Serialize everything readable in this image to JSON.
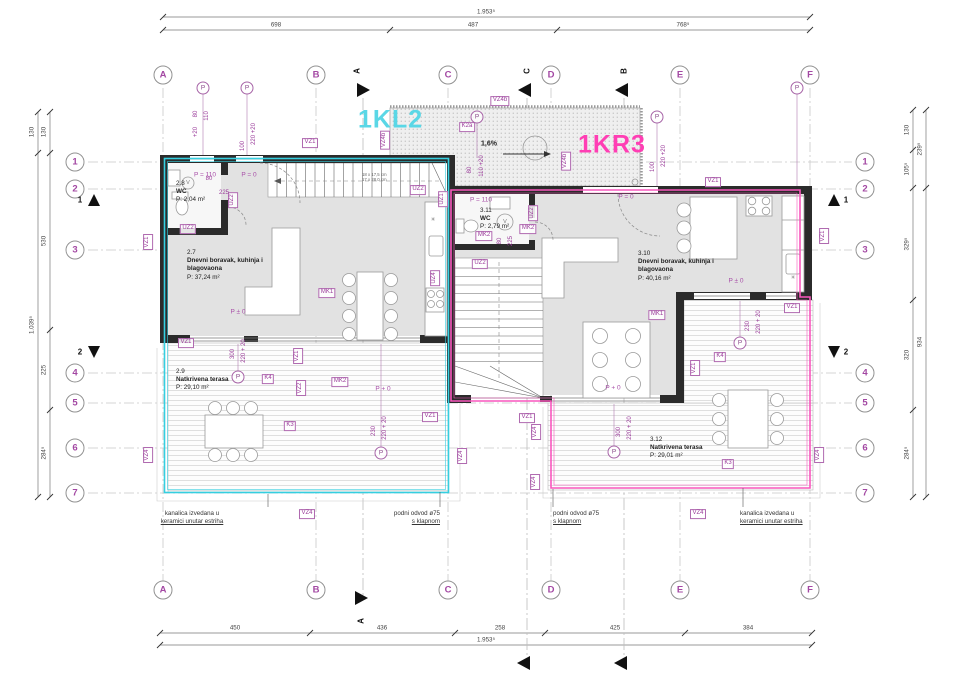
{
  "drawing": {
    "type": "floor-plan",
    "unit_left": {
      "code": "1KL2",
      "color": "#5ad7e6",
      "x": 358,
      "y": 120
    },
    "unit_right": {
      "code": "1KR3",
      "color": "#ff3eb4",
      "x": 578,
      "y": 145
    }
  },
  "grid": {
    "cols": [
      {
        "label": "A",
        "x": 163
      },
      {
        "label": "B",
        "x": 316
      },
      {
        "label": "C",
        "x": 448
      },
      {
        "label": "D",
        "x": 551
      },
      {
        "label": "E",
        "x": 680
      },
      {
        "label": "F",
        "x": 810
      }
    ],
    "rows": [
      {
        "label": "1",
        "y": 162
      },
      {
        "label": "2",
        "y": 189
      },
      {
        "label": "3",
        "y": 250
      },
      {
        "label": "4",
        "y": 373
      },
      {
        "label": "5",
        "y": 403
      },
      {
        "label": "6",
        "y": 448
      },
      {
        "label": "7",
        "y": 493
      }
    ],
    "top_y": 75,
    "bottom_y": 590,
    "left_x": 75,
    "right_x": 865
  },
  "dimensions": [
    {
      "dir": "h",
      "pos": 17,
      "from": 163,
      "to": 810,
      "ticks": [
        163,
        810
      ],
      "labels": [
        {
          "t": "1.953⁵",
          "at": 486
        }
      ]
    },
    {
      "dir": "h",
      "pos": 30,
      "from": 163,
      "to": 810,
      "ticks": [
        163,
        390,
        557,
        810
      ],
      "labels": [
        {
          "t": "698",
          "at": 276
        },
        {
          "t": "487",
          "at": 473
        },
        {
          "t": "768⁵",
          "at": 683
        }
      ]
    },
    {
      "dir": "h",
      "pos": 633,
      "from": 160,
      "to": 812,
      "ticks": [
        160,
        310,
        455,
        545,
        685,
        812
      ],
      "labels": [
        {
          "t": "450",
          "at": 235
        },
        {
          "t": "436",
          "at": 382
        },
        {
          "t": "258",
          "at": 500
        },
        {
          "t": "425",
          "at": 615
        },
        {
          "t": "384",
          "at": 748
        }
      ]
    },
    {
      "dir": "h",
      "pos": 645,
      "from": 160,
      "to": 812,
      "ticks": [
        160,
        812
      ],
      "labels": [
        {
          "t": "1.953⁵",
          "at": 486
        }
      ]
    },
    {
      "dir": "v",
      "pos": 38,
      "from": 112,
      "to": 497,
      "ticks": [
        112,
        153,
        497
      ],
      "labels": [
        {
          "t": "130",
          "at": 132
        },
        {
          "t": "1.039⁵",
          "at": 325
        }
      ]
    },
    {
      "dir": "v",
      "pos": 50,
      "from": 112,
      "to": 497,
      "ticks": [
        112,
        153,
        330,
        410,
        497
      ],
      "labels": [
        {
          "t": "130",
          "at": 132
        },
        {
          "t": "530",
          "at": 241
        },
        {
          "t": "225",
          "at": 370
        },
        {
          "t": "284⁵",
          "at": 453
        }
      ]
    },
    {
      "dir": "v",
      "pos": 913,
      "from": 110,
      "to": 497,
      "ticks": [
        110,
        150,
        188,
        300,
        410,
        497
      ],
      "labels": [
        {
          "t": "130",
          "at": 130
        },
        {
          "t": "105⁵",
          "at": 169
        },
        {
          "t": "329⁵",
          "at": 244
        },
        {
          "t": "320",
          "at": 355
        },
        {
          "t": "284⁵",
          "at": 453
        }
      ]
    },
    {
      "dir": "v",
      "pos": 926,
      "from": 110,
      "to": 497,
      "ticks": [
        110,
        188,
        497
      ],
      "labels": [
        {
          "t": "239⁵",
          "at": 149
        },
        {
          "t": "934",
          "at": 342
        }
      ]
    }
  ],
  "rooms": [
    {
      "id": "2.8",
      "name_lines": [
        "WC"
      ],
      "area": "P: 2,04 m²",
      "x": 176,
      "y": 180
    },
    {
      "id": "2.7",
      "name_lines": [
        "Dnevni boravak, kuhinja i",
        "blagovaona"
      ],
      "area": "P: 37,24 m²",
      "x": 187,
      "y": 249
    },
    {
      "id": "2.9",
      "name_lines": [
        "Natkrivena terasa"
      ],
      "area": "P: 29,10 m²",
      "x": 176,
      "y": 368
    },
    {
      "id": "3.11",
      "name_lines": [
        "WC"
      ],
      "area": "P: 2,79 m²",
      "x": 480,
      "y": 207
    },
    {
      "id": "3.10",
      "name_lines": [
        "Dnevni boravak, kuhinja i",
        "blagovaona"
      ],
      "area": "P: 40,16 m²",
      "x": 638,
      "y": 250
    },
    {
      "id": "3.12",
      "name_lines": [
        "Natkrivena terasa"
      ],
      "area": "P: 29,01 m²",
      "x": 650,
      "y": 436
    }
  ],
  "tags": [
    {
      "t": "VZ1",
      "x": 310,
      "y": 143
    },
    {
      "t": "VZ4b",
      "x": 500,
      "y": 101
    },
    {
      "t": "VZ4b",
      "x": 385,
      "y": 140,
      "v": true
    },
    {
      "t": "VZ4b",
      "x": 566,
      "y": 161,
      "v": true
    },
    {
      "t": "K2a",
      "x": 467,
      "y": 127
    },
    {
      "t": "UZ2",
      "x": 188,
      "y": 229
    },
    {
      "t": "UZ2",
      "x": 233,
      "y": 200,
      "v": true
    },
    {
      "t": "UZ2",
      "x": 418,
      "y": 190
    },
    {
      "t": "UZ1",
      "x": 443,
      "y": 199,
      "v": true
    },
    {
      "t": "VZ1",
      "x": 148,
      "y": 242,
      "v": true
    },
    {
      "t": "MK1",
      "x": 327,
      "y": 293
    },
    {
      "t": "UZ4",
      "x": 435,
      "y": 278,
      "v": true
    },
    {
      "t": "MK2",
      "x": 340,
      "y": 382
    },
    {
      "t": "VZ1",
      "x": 186,
      "y": 343
    },
    {
      "t": "VZ1",
      "x": 298,
      "y": 356,
      "v": true
    },
    {
      "t": "VZ2",
      "x": 301,
      "y": 388,
      "v": true
    },
    {
      "t": "K4",
      "x": 268,
      "y": 379
    },
    {
      "t": "K3",
      "x": 290,
      "y": 426
    },
    {
      "t": "VZ1",
      "x": 430,
      "y": 417
    },
    {
      "t": "VZ4",
      "x": 148,
      "y": 455,
      "v": true
    },
    {
      "t": "VZ4",
      "x": 462,
      "y": 456,
      "v": true
    },
    {
      "t": "VZ4",
      "x": 307,
      "y": 514
    },
    {
      "t": "VZ1",
      "x": 713,
      "y": 182
    },
    {
      "t": "UZ2",
      "x": 533,
      "y": 213,
      "v": true
    },
    {
      "t": "MK2",
      "x": 484,
      "y": 236
    },
    {
      "t": "MK2",
      "x": 528,
      "y": 229
    },
    {
      "t": "UZ2",
      "x": 480,
      "y": 264
    },
    {
      "t": "MK1",
      "x": 657,
      "y": 315
    },
    {
      "t": "VZ1",
      "x": 824,
      "y": 236,
      "v": true
    },
    {
      "t": "VZ1",
      "x": 792,
      "y": 308
    },
    {
      "t": "K4",
      "x": 720,
      "y": 357
    },
    {
      "t": "VZ1",
      "x": 695,
      "y": 368,
      "v": true
    },
    {
      "t": "VZ4",
      "x": 536,
      "y": 432,
      "v": true
    },
    {
      "t": "VZ1",
      "x": 527,
      "y": 418
    },
    {
      "t": "VZ4",
      "x": 535,
      "y": 482,
      "v": true
    },
    {
      "t": "K3",
      "x": 728,
      "y": 464
    },
    {
      "t": "VZ4",
      "x": 819,
      "y": 455,
      "v": true
    },
    {
      "t": "VZ4",
      "x": 698,
      "y": 514
    }
  ],
  "small_dims": [
    {
      "t": "+20",
      "x": 196,
      "y": 132,
      "v": true
    },
    {
      "t": "80",
      "x": 196,
      "y": 114,
      "v": true
    },
    {
      "t": "110",
      "x": 207,
      "y": 116,
      "v": true
    },
    {
      "t": "100",
      "x": 243,
      "y": 146,
      "v": true
    },
    {
      "t": "220 +20",
      "x": 254,
      "y": 134,
      "v": true
    },
    {
      "t": "80",
      "x": 470,
      "y": 170,
      "v": true
    },
    {
      "t": "110 +20",
      "x": 482,
      "y": 166,
      "v": true
    },
    {
      "t": "100",
      "x": 653,
      "y": 167,
      "v": true
    },
    {
      "t": "220 +20",
      "x": 664,
      "y": 156,
      "v": true
    },
    {
      "t": "80",
      "x": 209,
      "y": 179
    },
    {
      "t": "225",
      "x": 224,
      "y": 193
    },
    {
      "t": "80",
      "x": 500,
      "y": 241,
      "v": true
    },
    {
      "t": "225",
      "x": 511,
      "y": 241,
      "v": true
    },
    {
      "t": "300",
      "x": 233,
      "y": 354,
      "v": true
    },
    {
      "t": "220 + 20",
      "x": 244,
      "y": 351,
      "v": true
    },
    {
      "t": "230",
      "x": 374,
      "y": 431,
      "v": true
    },
    {
      "t": "220 + 20",
      "x": 385,
      "y": 428,
      "v": true
    },
    {
      "t": "230",
      "x": 748,
      "y": 326,
      "v": true
    },
    {
      "t": "220 + 20",
      "x": 759,
      "y": 322,
      "v": true
    },
    {
      "t": "300",
      "x": 619,
      "y": 432,
      "v": true
    },
    {
      "t": "220 + 20",
      "x": 630,
      "y": 428,
      "v": true
    }
  ],
  "levels": [
    {
      "t": "P = 110",
      "x": 205,
      "y": 175
    },
    {
      "t": "P = 0",
      "x": 249,
      "y": 175
    },
    {
      "t": "P = 110",
      "x": 481,
      "y": 200
    },
    {
      "t": "P = 0",
      "x": 626,
      "y": 197
    },
    {
      "t": "P ± 0",
      "x": 238,
      "y": 312
    },
    {
      "t": "P + 0",
      "x": 383,
      "y": 389
    },
    {
      "t": "P ± 0",
      "x": 736,
      "y": 281
    },
    {
      "t": "P + 0",
      "x": 613,
      "y": 388
    }
  ],
  "syms": [
    {
      "t": "V",
      "x": 188,
      "y": 183
    },
    {
      "t": "V",
      "x": 505,
      "y": 222
    },
    {
      "t": "✳",
      "x": 433,
      "y": 220
    },
    {
      "t": "✳",
      "x": 793,
      "y": 278
    }
  ],
  "p_markers": [
    {
      "t": "P",
      "x": 203,
      "y": 88
    },
    {
      "t": "P",
      "x": 247,
      "y": 88
    },
    {
      "t": "P",
      "x": 477,
      "y": 117
    },
    {
      "t": "P",
      "x": 657,
      "y": 117
    },
    {
      "t": "P",
      "x": 797,
      "y": 88
    },
    {
      "t": "P",
      "x": 238,
      "y": 377
    },
    {
      "t": "P",
      "x": 381,
      "y": 453
    },
    {
      "t": "P",
      "x": 614,
      "y": 452
    },
    {
      "t": "P",
      "x": 740,
      "y": 343
    }
  ],
  "section_letters": [
    {
      "t": "A",
      "x": 357,
      "y": 71,
      "v": true
    },
    {
      "t": "C",
      "x": 527,
      "y": 71,
      "v": true
    },
    {
      "t": "B",
      "x": 624,
      "y": 71,
      "v": true
    },
    {
      "t": "A",
      "x": 361,
      "y": 621,
      "v": true
    },
    {
      "t": "1",
      "x": 80,
      "y": 200
    },
    {
      "t": "2",
      "x": 80,
      "y": 352
    },
    {
      "t": "1",
      "x": 846,
      "y": 200
    },
    {
      "t": "2",
      "x": 846,
      "y": 352
    }
  ],
  "slope": {
    "t": "1,6%",
    "x": 489,
    "y": 144
  },
  "stair_note": {
    "lines": [
      "18 x 17,5 cm",
      "17 x 28,0 cm"
    ],
    "x": 362,
    "y": 172
  },
  "notes": [
    {
      "align": "center",
      "x": 192,
      "y": 510,
      "lines": [
        "kanalica izvedana u",
        "keramici unutar estriha"
      ]
    },
    {
      "align": "right",
      "x": 440,
      "y": 510,
      "lines": [
        "podni odvod ø75",
        "s klapnom"
      ]
    },
    {
      "align": "left",
      "x": 553,
      "y": 510,
      "lines": [
        "podni odvod ø75",
        "s klapnom"
      ]
    },
    {
      "align": "left",
      "x": 740,
      "y": 510,
      "lines": [
        "kanalica izvedana u",
        "keramici unutar estriha"
      ]
    }
  ]
}
